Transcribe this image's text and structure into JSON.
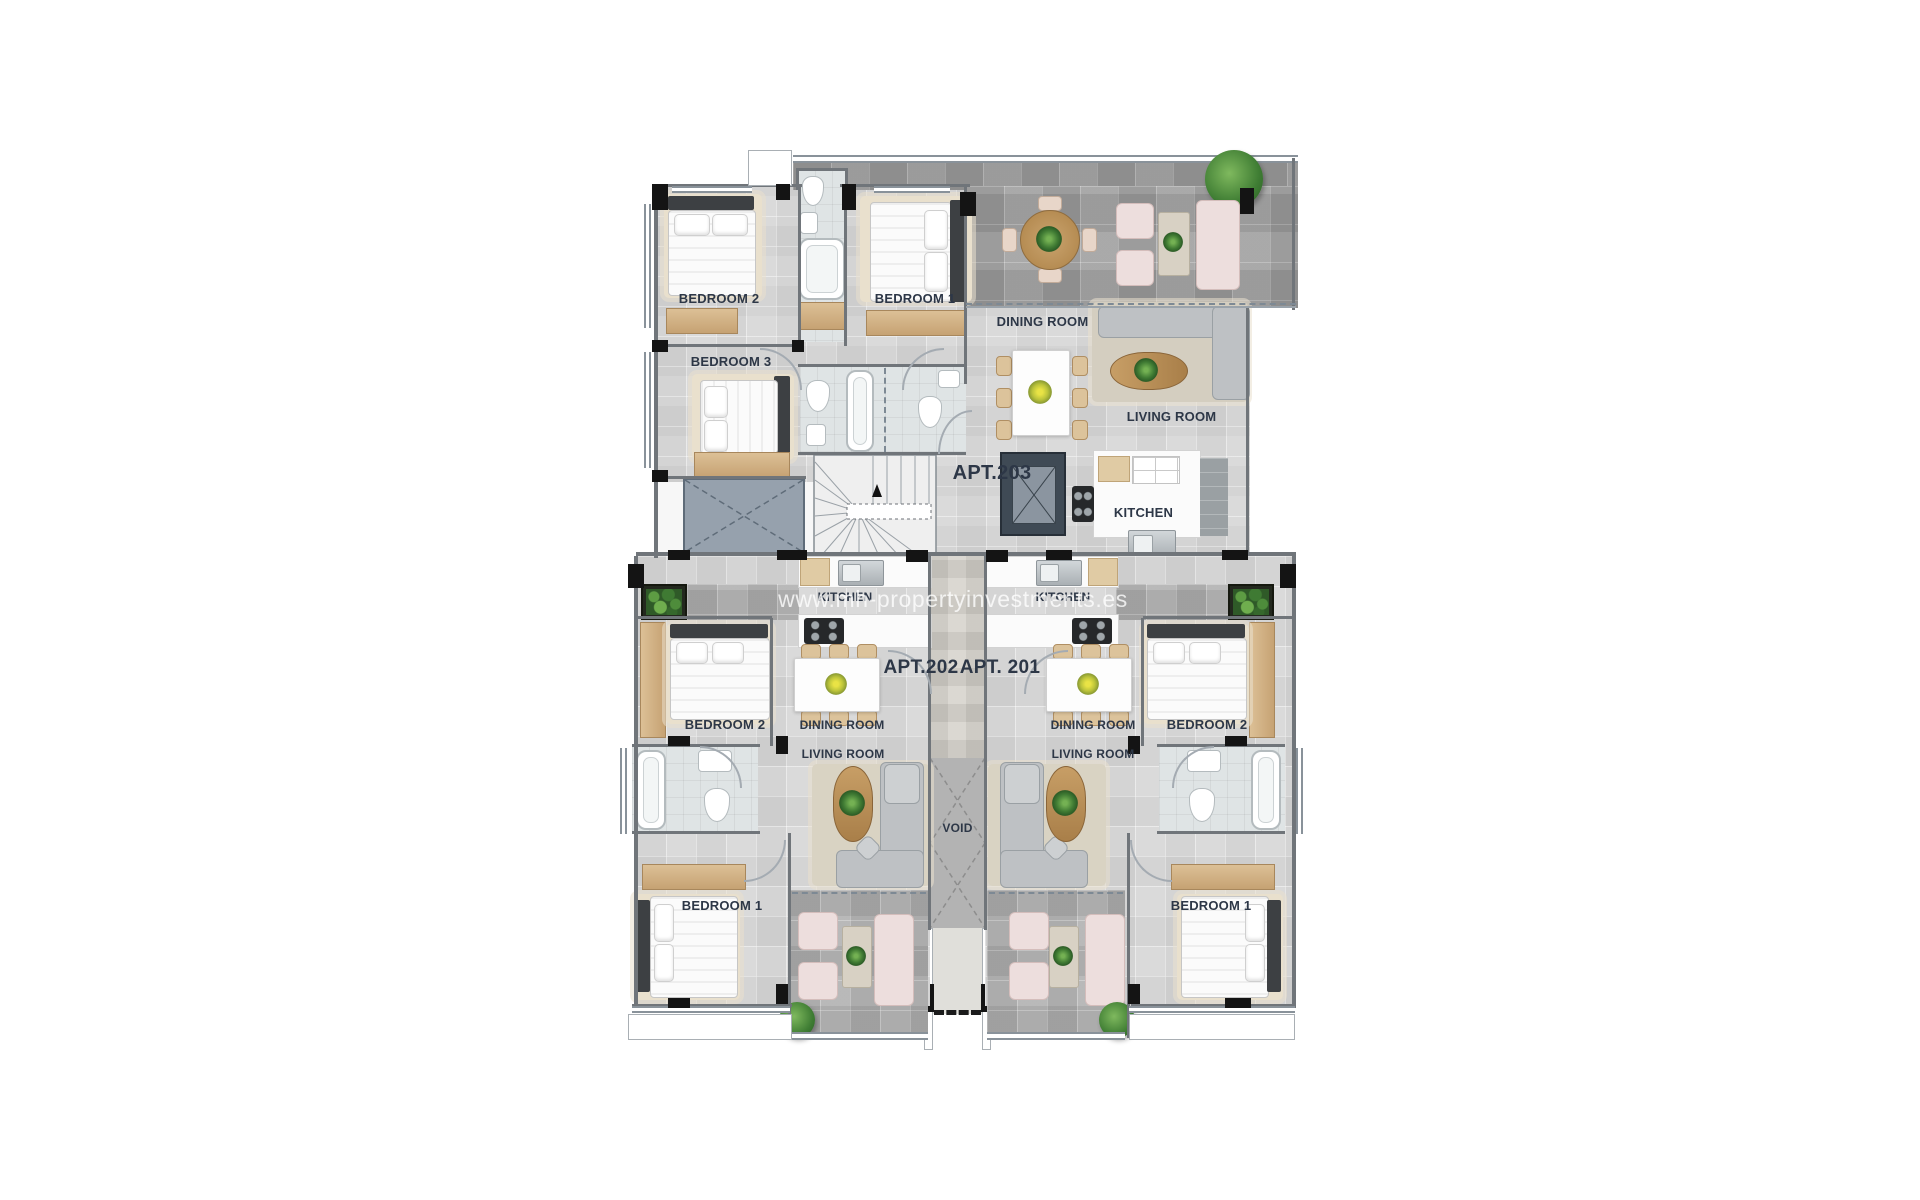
{
  "watermark": "www.mh-propertyinvestments.es",
  "labels": {
    "apt203": "APT.203",
    "apt202": "APT.202",
    "apt201": "APT. 201",
    "bedroom1": "BEDROOM 1",
    "bedroom2": "BEDROOM 2",
    "bedroom3": "BEDROOM 3",
    "dining": "DINING ROOM",
    "living": "LIVING ROOM",
    "kitchen": "KITCHEN",
    "void": "VOID"
  },
  "apartments": [
    {
      "id": "APT.203",
      "rooms": [
        "BEDROOM 1",
        "BEDROOM 2",
        "BEDROOM 3",
        "DINING ROOM",
        "LIVING ROOM",
        "KITCHEN"
      ]
    },
    {
      "id": "APT.202",
      "rooms": [
        "KITCHEN",
        "DINING ROOM",
        "LIVING ROOM",
        "BEDROOM 1",
        "BEDROOM 2"
      ]
    },
    {
      "id": "APT. 201",
      "rooms": [
        "KITCHEN",
        "DINING ROOM",
        "LIVING ROOM",
        "BEDROOM 1",
        "BEDROOM 2"
      ]
    }
  ],
  "shared": {
    "void": "VOID"
  },
  "colors": {
    "label": "#2d3747",
    "floor": "#d7d7d7",
    "terrace_dark": "#a0a0a0",
    "terrace_medium": "#b1b1b1",
    "wood": "#cfae7f",
    "pink_sofa": "#eddedd",
    "gray_sofa": "#bec1c4",
    "plant_green": "#417c34",
    "plant_yellow": "#bcc43b",
    "wall_black": "#141414"
  }
}
